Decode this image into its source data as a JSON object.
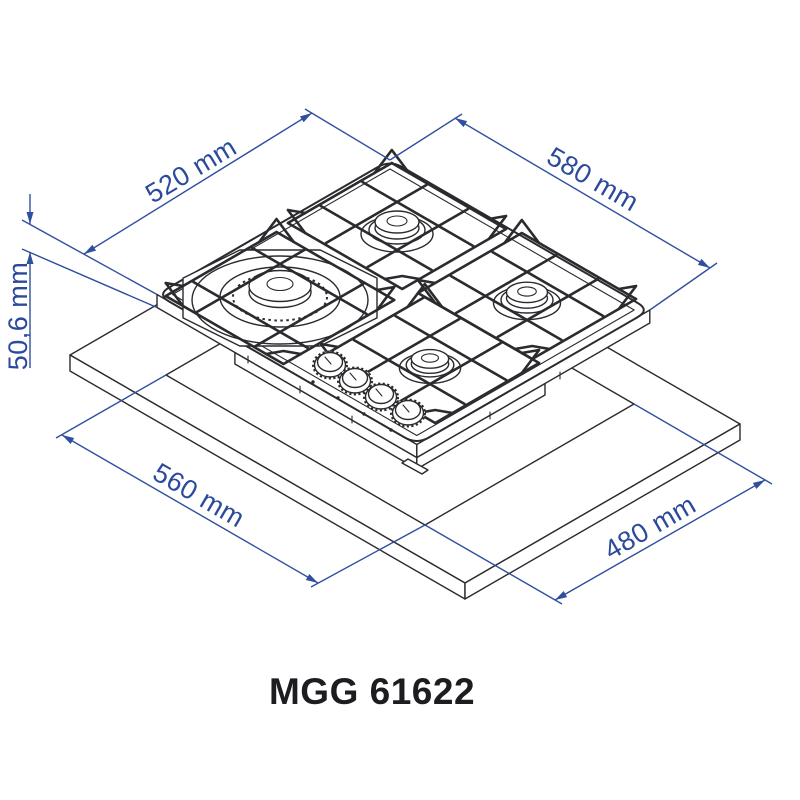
{
  "labels": {
    "dim_top_left": "520 mm",
    "dim_top_right": "580 mm",
    "dim_height": "50,6 mm",
    "dim_bottom_left": "560 mm",
    "dim_bottom_right": "480 mm",
    "title": "MGG 61622"
  },
  "colors": {
    "dimension_line": "#2f4f9f",
    "dimension_text": "#2b4a9c",
    "drawing_line": "#2b2b2f",
    "title_text": "#1d1d21",
    "background": "#ffffff"
  }
}
